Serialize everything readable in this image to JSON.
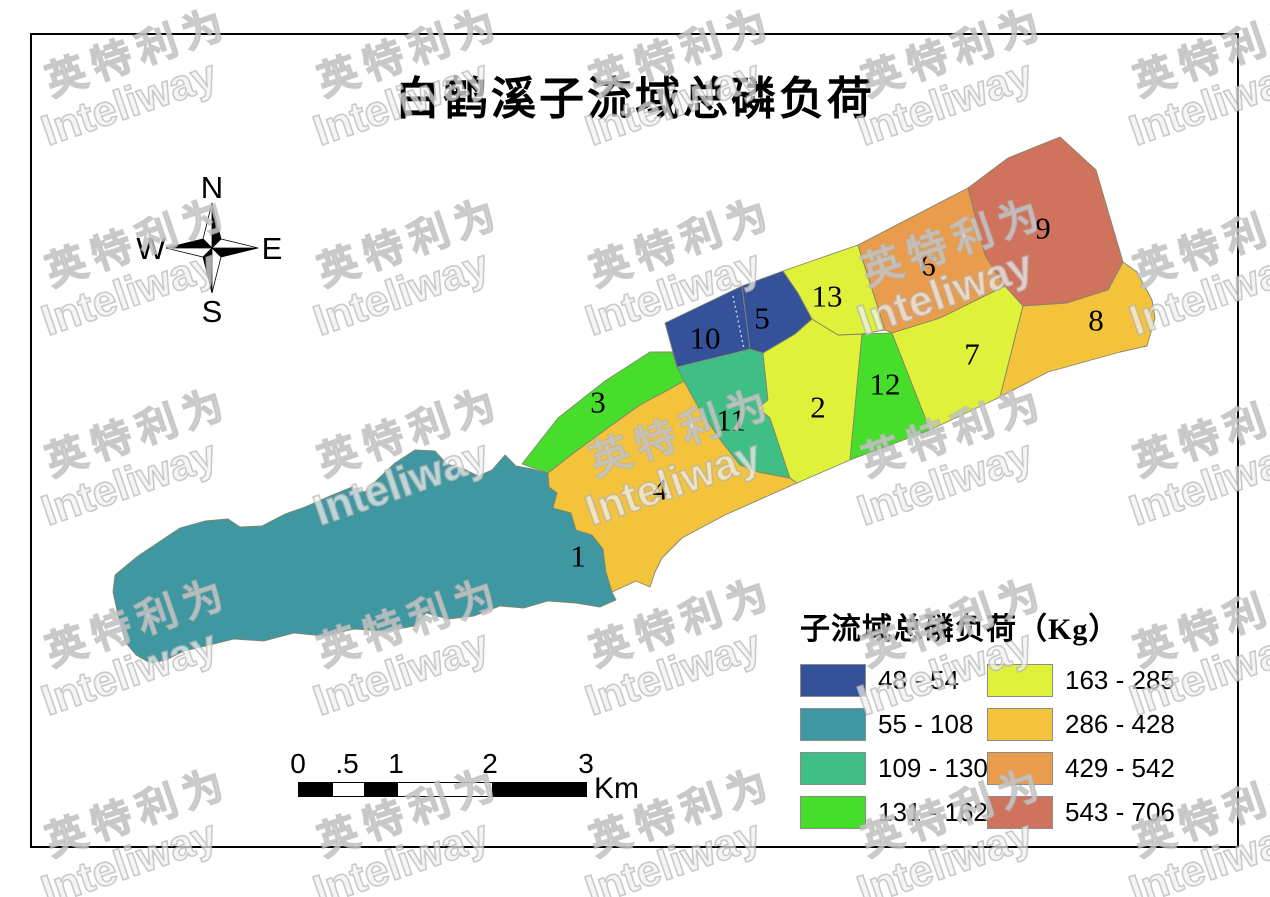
{
  "title": "白鹤溪子流域总磷负荷",
  "watermark": {
    "cjk": "英特利为",
    "latin": "Inteliway"
  },
  "compass": {
    "n": "N",
    "e": "E",
    "s": "S",
    "w": "W"
  },
  "scalebar": {
    "ticks": [
      "0",
      ".5",
      "1",
      "2",
      "3"
    ],
    "unit": "Km"
  },
  "legend": {
    "title": "子流域总磷负荷（Kg）",
    "items": [
      {
        "label": "48 - 54",
        "color": "#34519a"
      },
      {
        "label": "55 - 108",
        "color": "#3f97a1"
      },
      {
        "label": "109 - 130",
        "color": "#3fbf85"
      },
      {
        "label": "131 - 162",
        "color": "#47dd2b"
      },
      {
        "label": "163 - 285",
        "color": "#dff239"
      },
      {
        "label": "286 - 428",
        "color": "#f2c33b"
      },
      {
        "label": "429 - 542",
        "color": "#ea9c4d"
      },
      {
        "label": "543 - 706",
        "color": "#d0735c"
      }
    ]
  },
  "map": {
    "border_color": "#85856b",
    "divider": {
      "x1": 733,
      "y1": 296,
      "x2": 744,
      "y2": 349
    },
    "regions": [
      {
        "id": "1",
        "value_range": "55 - 108",
        "color": "#3f97a1",
        "label_x": 578,
        "label_y": 556,
        "points": "115,575 138,556 162,540 180,528 205,521 228,519 240,527 262,526 285,514 305,507 330,496 352,487 365,492 378,479 395,463 415,450 435,451 447,464 462,468 478,476 492,470 505,455 516,466 532,469 548,473 549,487 557,493 553,508 571,513 576,530 592,535 603,549 606,572 612,592 616,600 600,607 576,603 548,601 524,608 500,606 474,616 448,619 426,613 414,626 386,631 354,629 324,636 294,633 264,641 234,639 206,646 184,651 166,660 150,663 136,655 126,643 118,615 113,592"
      },
      {
        "id": "3",
        "value_range": "131 - 162",
        "color": "#47dd2b",
        "label_x": 598,
        "label_y": 402,
        "points": "522,464 558,418 605,381 650,352 672,352 677,367 684,381 668,390 640,405 605,430 575,452 548,473"
      },
      {
        "id": "4",
        "value_range": "286 - 428",
        "color": "#f2c33b",
        "label_x": 660,
        "label_y": 489,
        "points": "548,473 575,452 605,430 640,405 668,390 684,381 700,410 722,442 740,465 758,472 790,478 797,483 725,515 682,538 662,558 655,572 650,587 636,581 612,592 606,572 603,549 592,535 576,530 571,513 553,508 557,493 549,487"
      },
      {
        "id": "11",
        "value_range": "109 - 130",
        "color": "#3fbf85",
        "label_x": 731,
        "label_y": 420,
        "points": "677,367 750,349 763,353 768,400 758,408 770,418 790,478 758,472 740,465 722,442 700,410 684,381"
      },
      {
        "id": "2",
        "value_range": "163 - 285",
        "color": "#dff239",
        "label_x": 818,
        "label_y": 407,
        "points": "763,353 795,334 812,319 838,335 862,334 850,460 797,483 790,478 770,418 758,408 768,400"
      },
      {
        "id": "12",
        "value_range": "131 - 162",
        "color": "#47dd2b",
        "label_x": 885,
        "label_y": 384,
        "points": "862,334 892,333 930,430 850,460"
      },
      {
        "id": "7",
        "value_range": "163 - 285",
        "color": "#dff239",
        "label_x": 972,
        "label_y": 354,
        "points": "892,333 940,318 1005,286 1023,306 1000,397 930,430"
      },
      {
        "id": "10",
        "value_range": "48 - 54",
        "color": "#34519a",
        "label_x": 705,
        "label_y": 338,
        "points": "665,323 742,286 750,349 677,367"
      },
      {
        "id": "5",
        "value_range": "48 - 54",
        "color": "#34519a",
        "label_x": 762,
        "label_y": 318,
        "points": "742,286 783,271 798,293 812,319 795,334 763,353 750,349"
      },
      {
        "id": "13",
        "value_range": "163 - 285",
        "color": "#dff239",
        "label_x": 827,
        "label_y": 296,
        "points": "783,271 858,245 885,330 862,334 838,335 812,319 798,293"
      },
      {
        "id": "6",
        "value_range": "429 - 542",
        "color": "#ea9c4d",
        "label_x": 928,
        "label_y": 265,
        "points": "858,245 968,188 985,255 1005,286 940,318 892,333 885,330"
      },
      {
        "id": "9",
        "value_range": "543 - 706",
        "color": "#d0735c",
        "label_x": 1043,
        "label_y": 228,
        "points": "968,188 1008,158 1060,137 1096,170 1123,262 1108,290 1067,303 1023,306 1005,286 985,255"
      },
      {
        "id": "8",
        "value_range": "286 - 428",
        "color": "#f2c33b",
        "label_x": 1096,
        "label_y": 320,
        "points": "1023,306 1067,303 1108,290 1123,262 1137,272 1152,300 1155,318 1147,346 1120,352 1048,372 1000,397"
      }
    ]
  }
}
